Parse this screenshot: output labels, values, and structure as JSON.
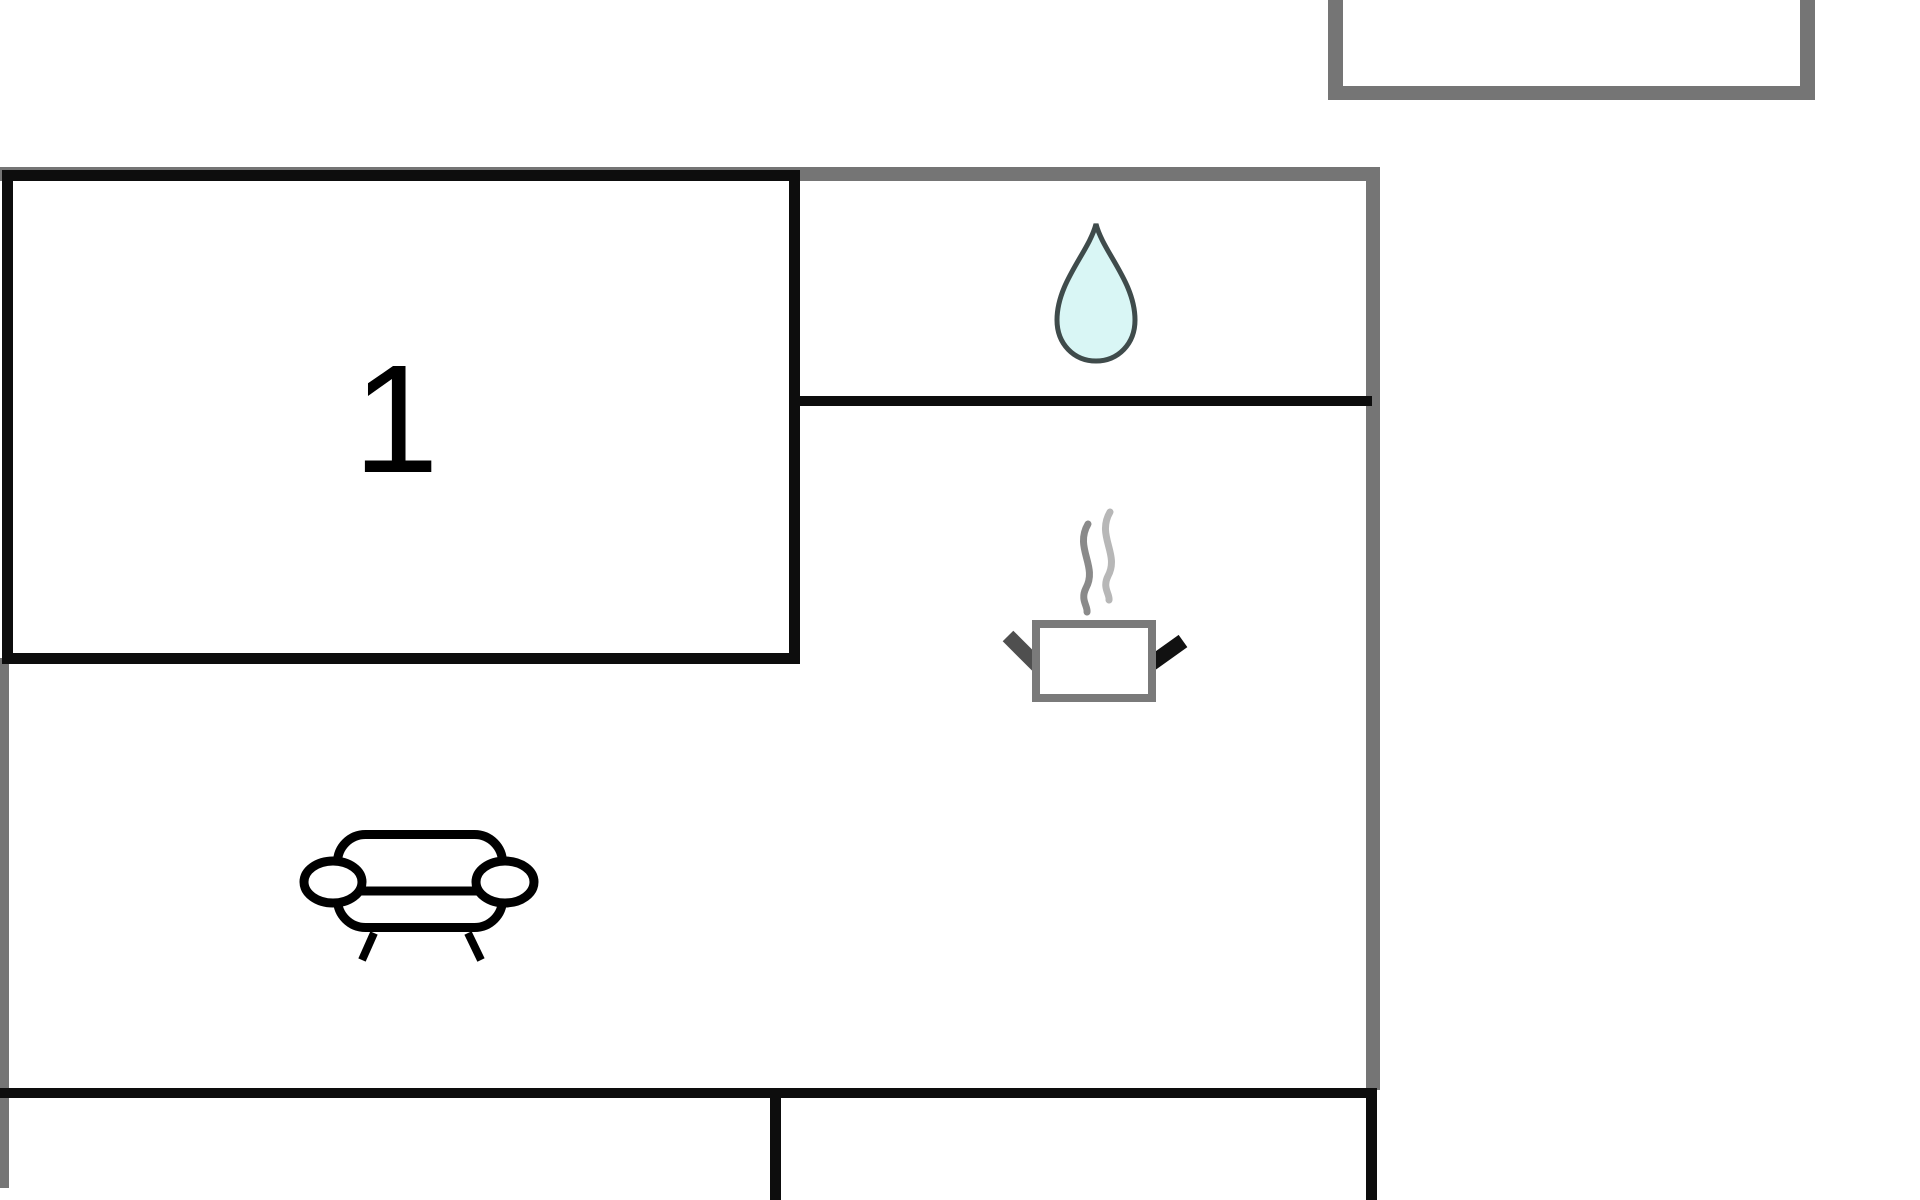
{
  "plan": {
    "rooms": {
      "room1": {
        "label": "1"
      }
    },
    "icons": [
      {
        "name": "water-drop-icon",
        "meaning": "bathroom / water"
      },
      {
        "name": "steaming-pot-icon",
        "meaning": "kitchen / cooking"
      },
      {
        "name": "sofa-icon",
        "meaning": "living area seating"
      }
    ]
  },
  "colors": {
    "wall_gray": "#757575",
    "line_black": "#0d0d0d",
    "drop_fill": "#d9f6f5",
    "drop_stroke": "#3f4b4b",
    "steam_dark": "#8a8a8a",
    "steam_light": "#b7b7b7",
    "pot_stroke": "#7a7a7a",
    "handle_dark": "#4f4f4f",
    "handle_black": "#111111",
    "sofa_stroke": "#000000"
  }
}
